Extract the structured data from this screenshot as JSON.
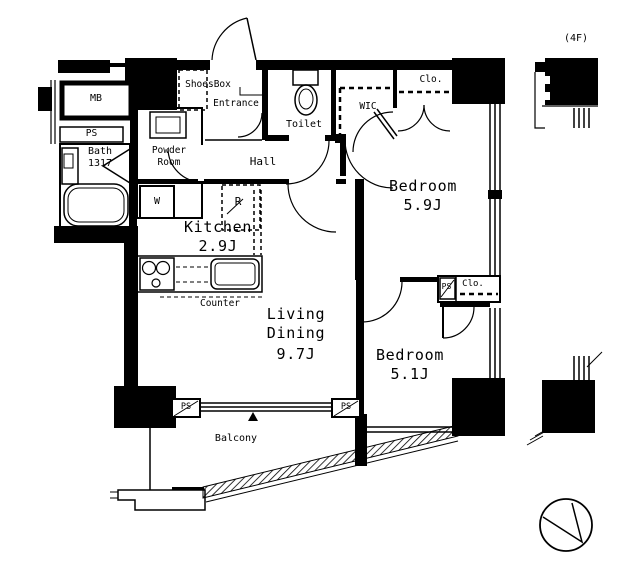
{
  "colors": {
    "line": "#000000",
    "background": "#ffffff"
  },
  "floor_tag": "(4F)",
  "rooms": {
    "entrance": {
      "label": "Entrance"
    },
    "shoes_box": {
      "label": "ShoesBox"
    },
    "toilet": {
      "label": "Toilet"
    },
    "wic": {
      "label": "WIC"
    },
    "closet_top": {
      "label": "Clo."
    },
    "closet_mid": {
      "label": "Clo."
    },
    "hall": {
      "label": "Hall"
    },
    "powder_room": {
      "line1": "Powder",
      "line2": "Room"
    },
    "bath": {
      "label": "Bath",
      "size": "1317"
    },
    "kitchen": {
      "label": "Kitchen",
      "size": "2.9J"
    },
    "living_dining": {
      "line1": "Living",
      "line2": "Dining",
      "size": "9.7J"
    },
    "bedroom_large": {
      "label": "Bedroom",
      "size": "5.9J"
    },
    "bedroom_small": {
      "label": "Bedroom",
      "size": "5.1J"
    },
    "balcony": {
      "label": "Balcony"
    }
  },
  "utilities": {
    "meter_box": "MB",
    "pipe_space_left": "PS",
    "pipe_space_mid": "PS",
    "pipe_space_balcony_left": "PS",
    "pipe_space_balcony_right": "PS"
  },
  "fixtures": {
    "refrigerator": "R",
    "washer": "W",
    "counter": "Counter"
  }
}
